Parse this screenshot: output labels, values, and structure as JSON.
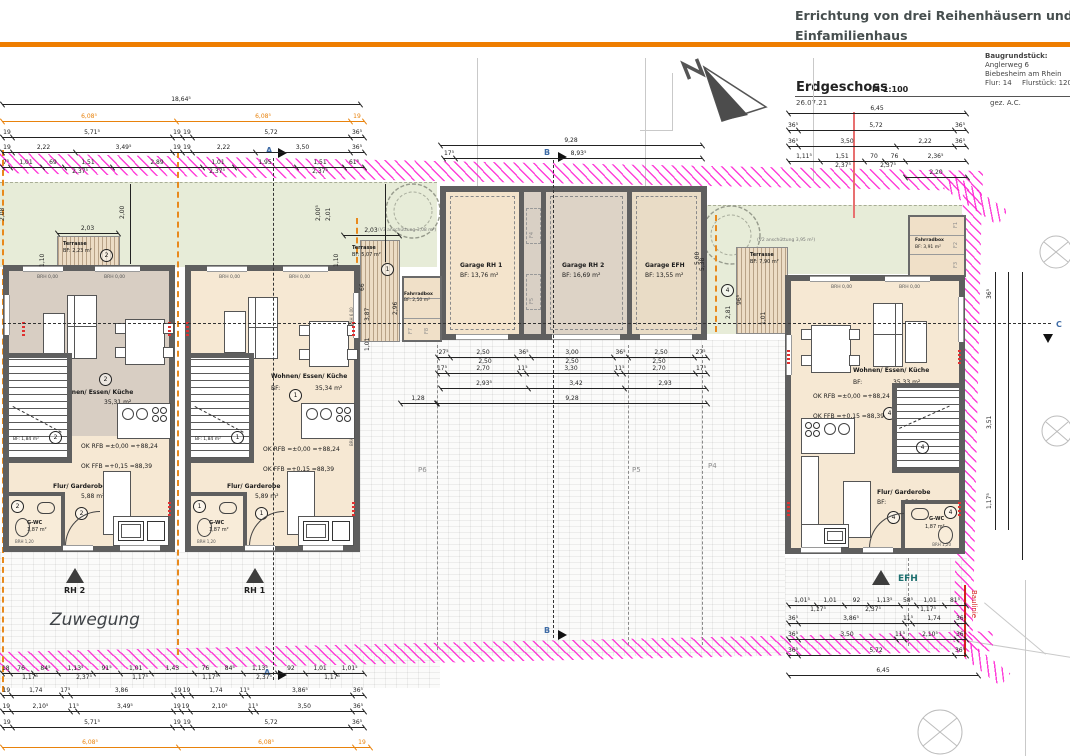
{
  "header": {
    "title_line1": "Errichtung von drei Reihenhäusern und einem",
    "title_line2": "Einfamilienhaus",
    "plot_label": "Baugrundstück:",
    "plot_address1": "Anglerweg 6",
    "plot_address2": "Biebesheim am Rhein",
    "plot_flur": "Flur: 14",
    "plot_flurstueck": "Flurstück: 120",
    "drawing_title": "Erdgeschoss",
    "scale": "M 1:100",
    "date": "26.07.21",
    "signed": "gez. A.C."
  },
  "site": {
    "zuwegung": "Zuwegung",
    "baulinie": "Baulinie",
    "north_label": "N",
    "parking": [
      "P6",
      "P5",
      "P4"
    ],
    "anschuett_left": "(V3 anschüttung 3,08 m²)",
    "anschuett_right": "(V2 anschüttung 3,95 m²)"
  },
  "markers": {
    "a": "A",
    "b": "B",
    "c": "C",
    "rh2": "RH 2",
    "rh1": "RH 1",
    "efh": "EFH"
  },
  "levels": {
    "rfb": "OK RFB =±0,00  =+88,24",
    "ffb": "OK FFB =+0,15 =88,39"
  },
  "houses": {
    "rh2": {
      "circle": "2",
      "living_label": "Wohnen/ Essen/ Küche",
      "bf": "BF:",
      "living_area": "35,31 m²",
      "flur_label": "Flur/ Garderobe",
      "flur_area": "5,88 m²",
      "wc_label": "G-WC",
      "wc_area": "1,87 m²",
      "stair_area": "BF: 1,84 m²",
      "brh0": "BRH 0,00",
      "brh12": "BRH 1,20"
    },
    "rh1": {
      "circle": "1",
      "living_label": "Wohnen/ Essen/ Küche",
      "bf": "BF:",
      "living_area": "35,34 m²",
      "flur_label": "Flur/ Garderobe",
      "flur_area": "5,89 m²",
      "wc_label": "G-WC",
      "wc_area": "1,87 m²",
      "stair_area": "BF: 1,84 m²",
      "brh0": "BRH 0,00",
      "brh12": "BRH 1,20",
      "brh6": "BRH 6,00"
    },
    "efh": {
      "circle": "4",
      "living_label": "Wohnen/ Essen/ Küche",
      "bf": "BF:",
      "living_area": "35,33 m²",
      "flur_label": "Flur/ Garderobe",
      "flur_area": "5,89 m²",
      "wc_label": "G-WC",
      "wc_area": "1,87 m²",
      "brh0": "BRH 0,00",
      "brh12": "BRH 1,20"
    }
  },
  "garages": {
    "g1_name": "Garage RH 1",
    "g1_bf": "BF: 13,76 m²",
    "g2_name": "Garage RH 2",
    "g2_bf": "BF: 16,69 m²",
    "g3_name": "Garage EFH",
    "g3_bf": "BF: 13,55 m²",
    "doors": [
      "F4",
      "F5"
    ]
  },
  "bike_left": {
    "name": "Fahrradbox",
    "bf": "BF: 2,50 m²",
    "doors": [
      "F7",
      "F8"
    ]
  },
  "bike_right": {
    "name": "Fahrradbox",
    "bf": "BF: 3,91 m²",
    "doors": [
      "F1",
      "F2",
      "F3"
    ]
  },
  "terraces": {
    "t1_label": "Terrasse",
    "t1_bf": "BF: 2,23 m²",
    "t1_circle": "2",
    "t2_label": "Terrasse",
    "t2_bf": "BF: 5,07 m²",
    "t2_circle": "1",
    "t3_label": "Terrasse",
    "t3_bf": "BF: 7,90 m²",
    "t3_circle": "4"
  },
  "dims": {
    "rows": [
      {
        "x": 2,
        "y": 97,
        "w": 358,
        "segs": [
          [
            "18,64⁵",
            1
          ]
        ]
      },
      {
        "x": 2,
        "y": 114,
        "w": 362,
        "c": "or",
        "segs": [
          [
            "6,08⁵",
            174
          ],
          [
            "6,08⁵",
            174
          ],
          [
            "19",
            14
          ]
        ]
      },
      {
        "x": 2,
        "y": 130,
        "w": 362,
        "segs": [
          [
            "19",
            10
          ],
          [
            "5,71⁵",
            160
          ],
          [
            "19",
            10
          ],
          [
            "19",
            10
          ],
          [
            "5,72",
            158
          ],
          [
            "36⁵",
            14
          ]
        ]
      },
      {
        "x": 2,
        "y": 145,
        "w": 362,
        "segs": [
          [
            "19",
            10
          ],
          [
            "2,22",
            63
          ],
          [
            "3,49⁵",
            97
          ],
          [
            "19",
            10
          ],
          [
            "19",
            10
          ],
          [
            "2,22",
            63
          ],
          [
            "3,50",
            95
          ],
          [
            "36⁵",
            14
          ]
        ]
      },
      {
        "x": 2,
        "y": 160,
        "w": 362,
        "segs": [
          [
            "7⁵",
            8
          ],
          [
            "1,01",
            32
          ],
          [
            "69",
            22
          ],
          [
            "1,51",
            48
          ],
          [
            "2,89",
            90
          ],
          [
            "1,01",
            32
          ],
          [
            "1,95",
            62
          ],
          [
            "1,51",
            48
          ],
          [
            "61⁵",
            20
          ]
        ],
        "subs": [
          [
            "2,37⁵",
            78
          ],
          [
            "2,37⁵",
            215
          ],
          [
            "2,37⁵",
            318
          ]
        ]
      },
      {
        "x": 440,
        "y": 138,
        "w": 262,
        "segs": [
          [
            "9,28",
            1
          ]
        ]
      },
      {
        "x": 443,
        "y": 151,
        "w": 259,
        "segs": [
          [
            "17⁵",
            12
          ],
          [
            "8,93⁵",
            247
          ]
        ]
      },
      {
        "x": 788,
        "y": 106,
        "w": 178,
        "segs": [
          [
            "6,45",
            1
          ]
        ]
      },
      {
        "x": 788,
        "y": 123,
        "w": 178,
        "segs": [
          [
            "36⁵",
            10
          ],
          [
            "5,72",
            156
          ],
          [
            "36⁵",
            12
          ]
        ]
      },
      {
        "x": 788,
        "y": 139,
        "w": 178,
        "segs": [
          [
            "36⁵",
            10
          ],
          [
            "3,50",
            98
          ],
          [
            "2,22",
            58
          ],
          [
            "36⁵",
            12
          ]
        ]
      },
      {
        "x": 788,
        "y": 154,
        "w": 178,
        "segs": [
          [
            "1,11⁵",
            32
          ],
          [
            "1,51",
            44
          ],
          [
            "70",
            20
          ],
          [
            "76",
            21
          ],
          [
            "2,36⁵",
            61
          ]
        ],
        "subs": [
          [
            "2,37⁵",
            55
          ],
          [
            "2,37⁵",
            100
          ]
        ]
      },
      {
        "x": 905,
        "y": 170,
        "w": 62,
        "segs": [
          [
            "2,20",
            1
          ]
        ]
      },
      {
        "x": 57,
        "y": 226,
        "w": 61,
        "segs": [
          [
            "2,03",
            1
          ]
        ]
      },
      {
        "x": 343,
        "y": 228,
        "w": 56,
        "segs": [
          [
            "2,03",
            1
          ]
        ]
      },
      {
        "x": 437,
        "y": 350,
        "w": 270,
        "segs": [
          [
            "27⁵",
            13
          ],
          [
            "2,50",
            66
          ],
          [
            "36⁵",
            15
          ],
          [
            "3,00",
            82
          ],
          [
            "36⁵",
            15
          ],
          [
            "2,50",
            66
          ],
          [
            "27⁵",
            13
          ]
        ],
        "subs": [
          [
            "2,50",
            48
          ],
          [
            "2,50",
            135
          ],
          [
            "2,50",
            222
          ]
        ]
      },
      {
        "x": 437,
        "y": 366,
        "w": 270,
        "segs": [
          [
            "17⁵",
            10
          ],
          [
            "2,70",
            72
          ],
          [
            "11⁵",
            7
          ],
          [
            "3,30",
            90
          ],
          [
            "11⁵",
            7
          ],
          [
            "2,70",
            72
          ],
          [
            "17⁵",
            12
          ]
        ]
      },
      {
        "x": 440,
        "y": 381,
        "w": 266,
        "segs": [
          [
            "2,93⁵",
            88
          ],
          [
            "3,42",
            96
          ],
          [
            "2,93",
            82
          ]
        ]
      },
      {
        "x": 400,
        "y": 396,
        "w": 36,
        "segs": [
          [
            "1,28",
            1
          ]
        ]
      },
      {
        "x": 437,
        "y": 396,
        "w": 270,
        "segs": [
          [
            "9,28",
            1
          ]
        ]
      },
      {
        "x": 788,
        "y": 598,
        "w": 178,
        "segs": [
          [
            "1,01⁵",
            28
          ],
          [
            "1,01",
            28
          ],
          [
            "92",
            25
          ],
          [
            "1,13⁵",
            31
          ],
          [
            "58⁵",
            16
          ],
          [
            "1,01",
            28
          ],
          [
            "81⁵",
            22
          ]
        ],
        "subs": [
          [
            "1,17⁵",
            30
          ],
          [
            "2,37⁵",
            85
          ],
          [
            "1,17⁵",
            140
          ]
        ]
      },
      {
        "x": 788,
        "y": 616,
        "w": 178,
        "segs": [
          [
            "36⁵",
            10
          ],
          [
            "3,86⁵",
            106
          ],
          [
            "11⁵",
            8
          ],
          [
            "1,74",
            44
          ],
          [
            "36⁵",
            10
          ]
        ]
      },
      {
        "x": 788,
        "y": 632,
        "w": 178,
        "segs": [
          [
            "36⁵",
            10
          ],
          [
            "3,50",
            98
          ],
          [
            "11⁵",
            8
          ],
          [
            "2,10⁵",
            52
          ],
          [
            "36⁵",
            10
          ]
        ]
      },
      {
        "x": 788,
        "y": 648,
        "w": 178,
        "segs": [
          [
            "36⁵",
            10
          ],
          [
            "5,72",
            156
          ],
          [
            "36⁵",
            12
          ]
        ]
      },
      {
        "x": 788,
        "y": 668,
        "w": 190,
        "segs": [
          [
            "6,45",
            1
          ]
        ]
      },
      {
        "x": 2,
        "y": 666,
        "w": 362,
        "segs": [
          [
            "18",
            8
          ],
          [
            "76",
            24
          ],
          [
            "84⁵",
            27
          ],
          [
            "1,13⁵",
            36
          ],
          [
            "91⁵",
            29
          ],
          [
            "1,01",
            32
          ],
          [
            "1,43",
            45
          ],
          [
            "76",
            24
          ],
          [
            "84⁵",
            27
          ],
          [
            "1,13⁵",
            36
          ],
          [
            "92",
            29
          ],
          [
            "1,01",
            32
          ],
          [
            "1,01⁵",
            30
          ]
        ],
        "subs": [
          [
            "1,17⁵",
            28
          ],
          [
            "2,37⁵",
            82
          ],
          [
            "1,17⁵",
            138
          ],
          [
            "1,17⁵",
            208
          ],
          [
            "2,37⁵",
            262
          ],
          [
            "1,17⁵",
            330
          ]
        ]
      },
      {
        "x": 2,
        "y": 688,
        "w": 362,
        "segs": [
          [
            "19",
            10
          ],
          [
            "1,74",
            58
          ],
          [
            "17⁵",
            10
          ],
          [
            "3,86",
            120
          ],
          [
            "19",
            10
          ],
          [
            "19",
            10
          ],
          [
            "1,74",
            58
          ],
          [
            "11⁵",
            8
          ],
          [
            "3,86⁵",
            120
          ],
          [
            "36⁵",
            14
          ]
        ]
      },
      {
        "x": 2,
        "y": 704,
        "w": 362,
        "segs": [
          [
            "19",
            10
          ],
          [
            "2,10⁵",
            70
          ],
          [
            "11⁵",
            8
          ],
          [
            "3,49⁵",
            112
          ],
          [
            "19",
            10
          ],
          [
            "19",
            10
          ],
          [
            "2,10⁵",
            70
          ],
          [
            "11⁵",
            8
          ],
          [
            "3,50",
            112
          ],
          [
            "36⁵",
            14
          ]
        ]
      },
      {
        "x": 2,
        "y": 720,
        "w": 362,
        "segs": [
          [
            "19",
            10
          ],
          [
            "5,71⁵",
            162
          ],
          [
            "19",
            10
          ],
          [
            "19",
            10
          ],
          [
            "5,72",
            160
          ],
          [
            "36⁵",
            14
          ]
        ]
      },
      {
        "x": 2,
        "y": 740,
        "w": 368,
        "c": "or",
        "segs": [
          [
            "6,08⁵",
            176
          ],
          [
            "6,08⁵",
            176
          ],
          [
            "19",
            16
          ]
        ]
      }
    ],
    "vlabels": [
      [
        "2,08",
        6,
        214
      ],
      [
        "1,10",
        46,
        260
      ],
      [
        "2,00",
        126,
        212
      ],
      [
        "2,00⁵",
        322,
        214
      ],
      [
        "2,01",
        332,
        214
      ],
      [
        "1,10",
        340,
        260
      ],
      [
        "66",
        366,
        284
      ],
      [
        "3,87",
        371,
        314
      ],
      [
        "1,01",
        371,
        344
      ],
      [
        "2,96",
        399,
        308
      ],
      [
        "5,00",
        701,
        258
      ],
      [
        "5,38",
        706,
        264
      ],
      [
        "96⁵",
        743,
        298
      ],
      [
        "2,81",
        732,
        312
      ],
      [
        "1,01",
        767,
        318
      ],
      [
        "36⁵",
        993,
        292
      ],
      [
        "3,51",
        993,
        422
      ],
      [
        "1,17⁵",
        993,
        502
      ]
    ],
    "vlines": [
      {
        "x": 995,
        "y": 272,
        "h": 258
      },
      {
        "x": 1008,
        "y": 272,
        "h": 258
      },
      {
        "x": 1022,
        "y": 272,
        "h": 288
      },
      {
        "x": 130,
        "y": 184,
        "h": 80
      },
      {
        "x": 385,
        "y": 184,
        "h": 78
      }
    ]
  }
}
